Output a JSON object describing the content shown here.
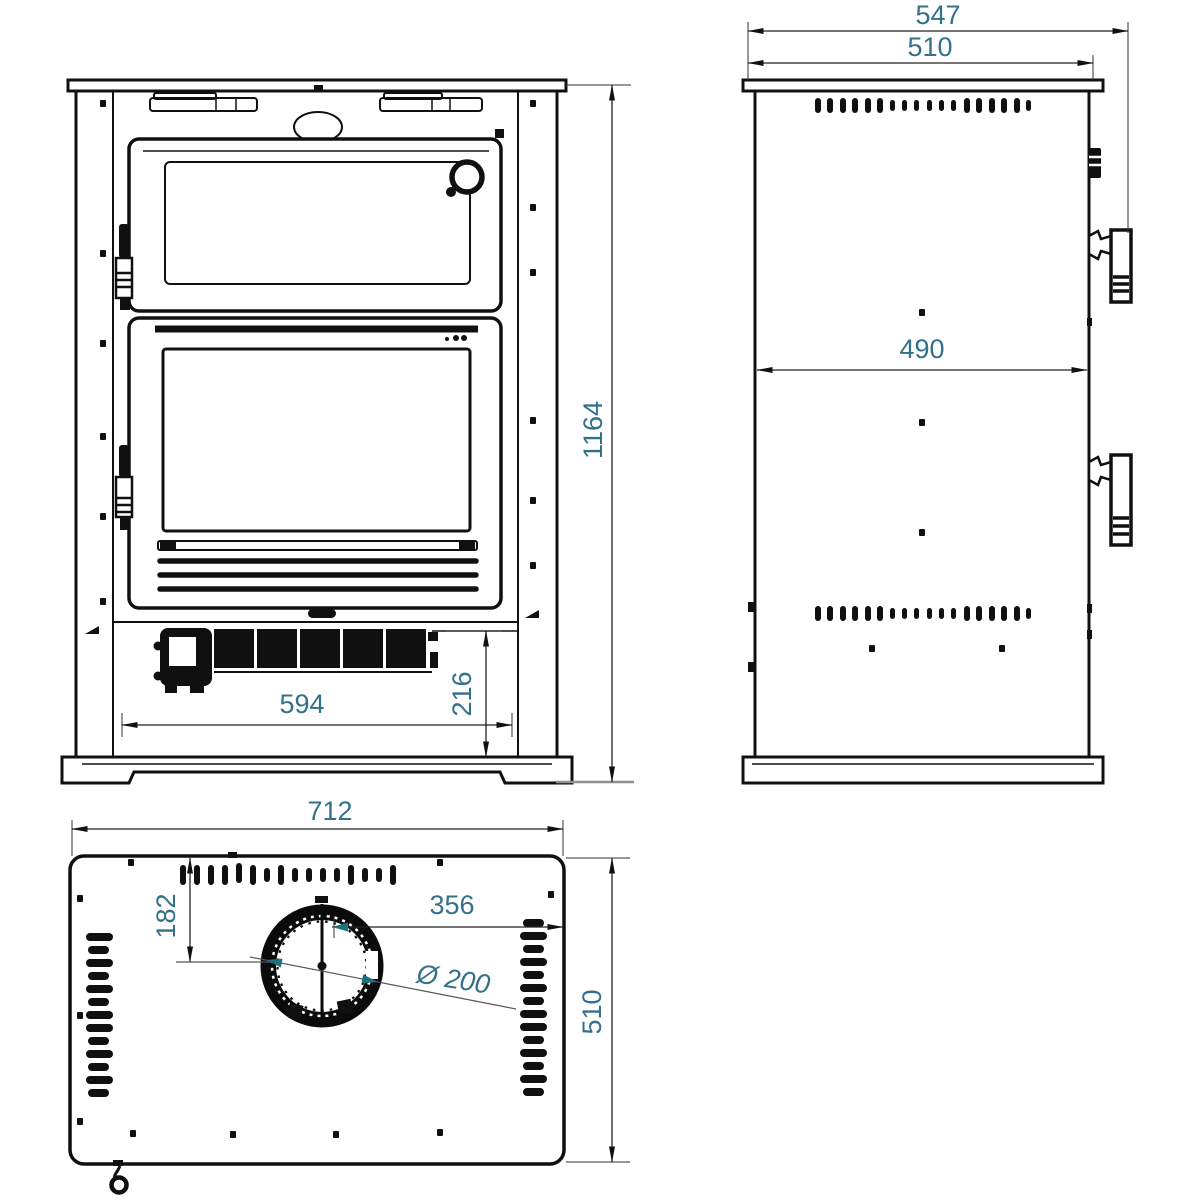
{
  "drawing": {
    "colors": {
      "line": "#101010",
      "dimension_text": "#33718a",
      "accent_arrow": "#20707c",
      "background": "#ffffff"
    }
  },
  "front_view": {
    "dims": {
      "height": "1164",
      "width": "594",
      "base_height": "216"
    }
  },
  "side_view": {
    "dims": {
      "depth_overall": "547",
      "depth_top": "510",
      "depth_body": "490"
    }
  },
  "top_view": {
    "dims": {
      "width": "712",
      "flue_offset_front": "182",
      "flue_offset_right": "356",
      "flue_diameter": "Ø 200",
      "depth": "510"
    }
  }
}
